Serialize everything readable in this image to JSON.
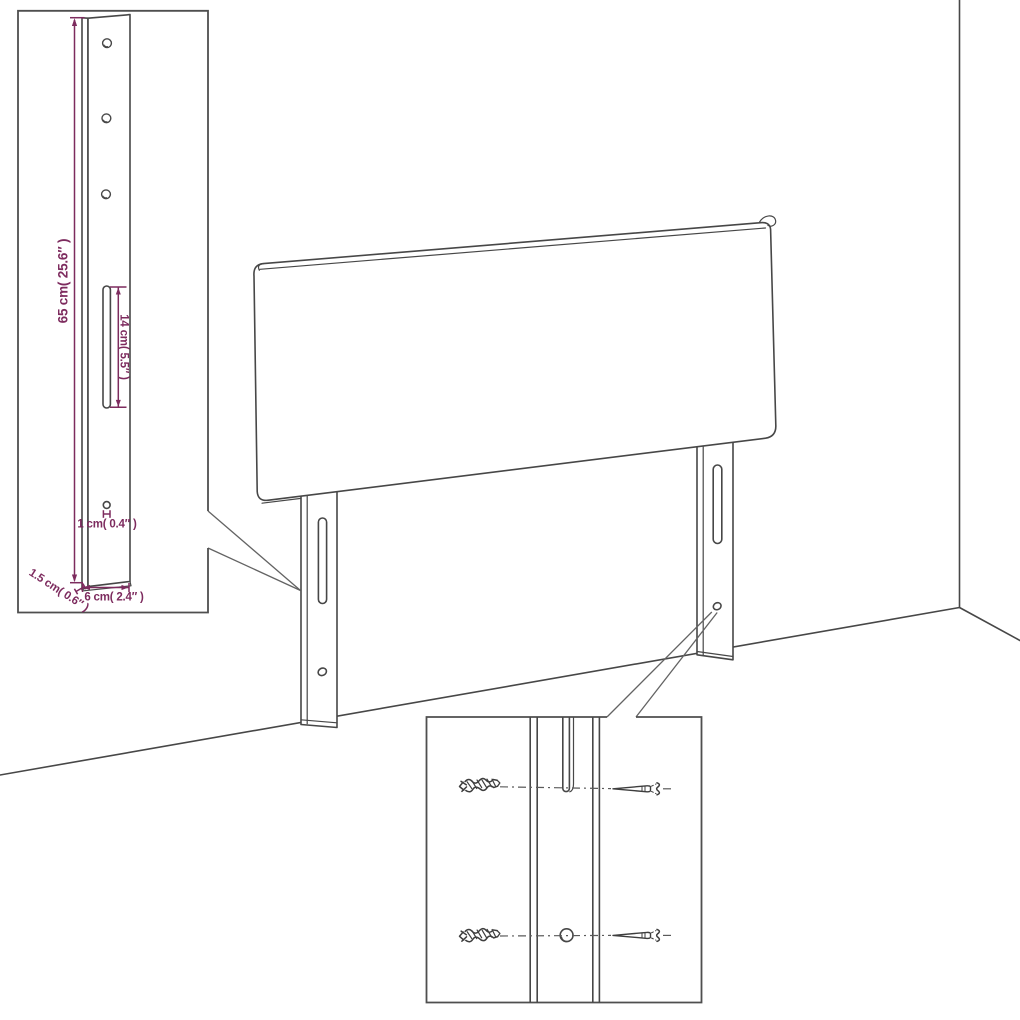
{
  "page": {
    "description": "Technical line drawing of a headboard with two wall-mount legs shown in a room corner, with a dimensioned leg detail inset and a mounting hardware detail inset",
    "background": "#ffffff"
  },
  "colors": {
    "line": "#474747",
    "dimension_text": "#7d2b5e"
  },
  "leg_detail_inset": {
    "dimensions": {
      "leg_height": "65 cm( 25.6″ )",
      "slot_length": "14 cm( 5.5″ )",
      "hole_width": "1 cm( 0.4″ )",
      "leg_thickness": "1.5 cm( 0.6″ )",
      "leg_width": "6 cm( 2.4″ )"
    }
  },
  "mounting_inset": {
    "hardware": [
      "wall-plug-icon",
      "screw-icon",
      "keyhole-slot",
      "screw-hole"
    ]
  }
}
